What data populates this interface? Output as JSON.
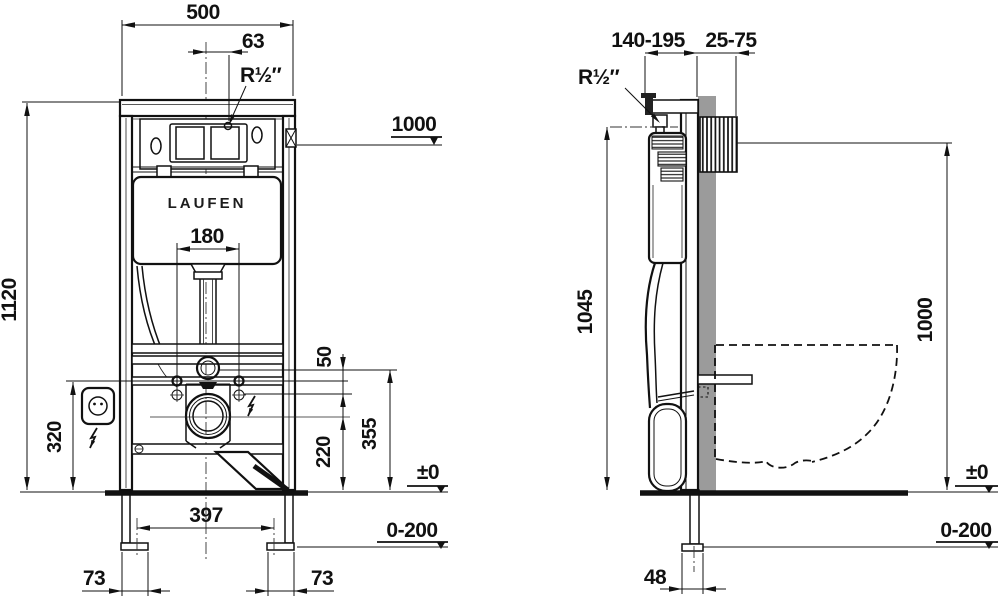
{
  "brand": "LAUFEN",
  "front_view": {
    "width_top": "500",
    "supply_offset": "63",
    "water_connection": "R½″",
    "height_marker": "1000",
    "frame_height": "1120",
    "plate_width": "180",
    "socket_height": "320",
    "bolt_gap": "50",
    "supply_height": "355",
    "drain_height": "220",
    "floor_level": "±0",
    "floor_adjust": "0-200",
    "foot_span": "397",
    "foot_offset_left": "73",
    "foot_offset_right": "73"
  },
  "side_view": {
    "frame_depth": "140-195",
    "finish_depth": "25-75",
    "water_connection": "R½″",
    "frame_height": "1045",
    "height_marker": "1000",
    "floor_level": "±0",
    "floor_adjust": "0-200",
    "foot_depth": "48"
  },
  "colors": {
    "line": "#111111",
    "wall_fill": "#9b9b9b",
    "background": "#ffffff"
  }
}
